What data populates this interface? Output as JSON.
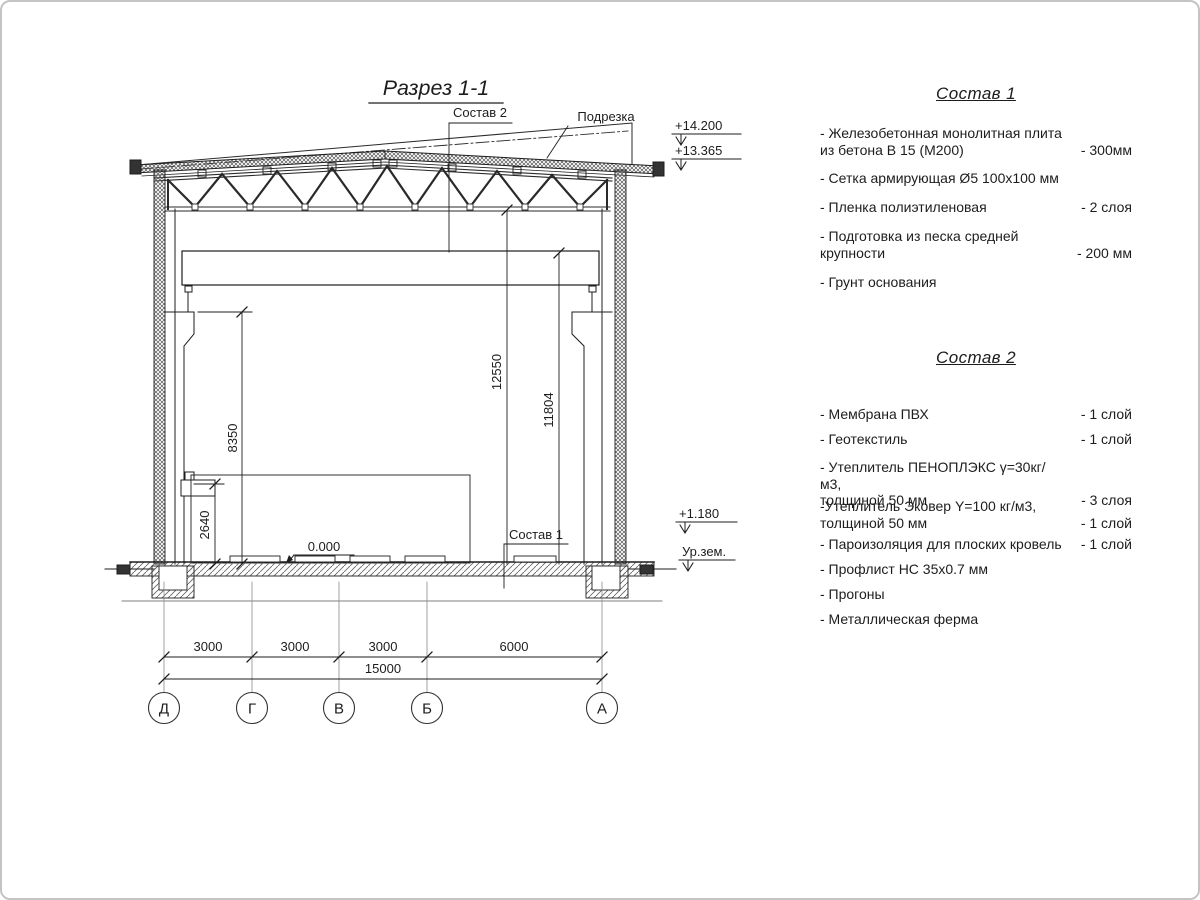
{
  "drawing": {
    "title": "Разрез 1-1",
    "labels": {
      "sostav2": "Состав 2",
      "podrezka": "Подрезка",
      "sostav1": "Состав 1"
    },
    "elevations": {
      "roof_top": "+14.200",
      "roof_low": "+13.365",
      "plinth": "+1.180",
      "ground": "Ур.зем.",
      "floor_zero": "0.000"
    },
    "dims": {
      "col_head": "8350",
      "corbel": "2640",
      "clear_mid": "12550",
      "clear_eave": "11804",
      "spans": [
        "3000",
        "3000",
        "3000",
        "6000"
      ],
      "total": "15000"
    },
    "axes": [
      "Д",
      "Г",
      "В",
      "Б",
      "А"
    ]
  },
  "composition1": {
    "title": "Состав 1",
    "items": [
      {
        "name": "- Железобетонная  монолитная плита\nиз бетона В 15 (М200)",
        "value": "- 300мм"
      },
      {
        "name": "- Сетка армирующая Ø5 100x100 мм",
        "value": ""
      },
      {
        "name": "- Пленка полиэтиленовая",
        "value": "-  2 слоя"
      },
      {
        "name": "- Подготовка из песка средней\nкрупности",
        "value": "- 200 мм"
      },
      {
        "name": "- Грунт основания",
        "value": ""
      }
    ]
  },
  "composition2": {
    "title": "Состав 2",
    "items": [
      {
        "name": "- Мембрана ПВХ",
        "value": "- 1 слой"
      },
      {
        "name": "- Геотекстиль",
        "value": "- 1 слой"
      },
      {
        "name": "- Утеплитель ПЕНОПЛЭКС γ=30кг/м3,\nтолщиной 50 мм",
        "value": "- 3 слоя"
      },
      {
        "name": "-Утеплитель Эковер Y=100 кг/м3,\nтолщиной 50 мм",
        "value": "- 1 слой"
      },
      {
        "name": "- Пароизоляция для плоских кровель",
        "value": "- 1 слой"
      },
      {
        "name": "- Профлист НС 35x0.7 мм",
        "value": ""
      },
      {
        "name": "- Прогоны",
        "value": ""
      },
      {
        "name": "- Металлическая ферма",
        "value": ""
      }
    ]
  }
}
